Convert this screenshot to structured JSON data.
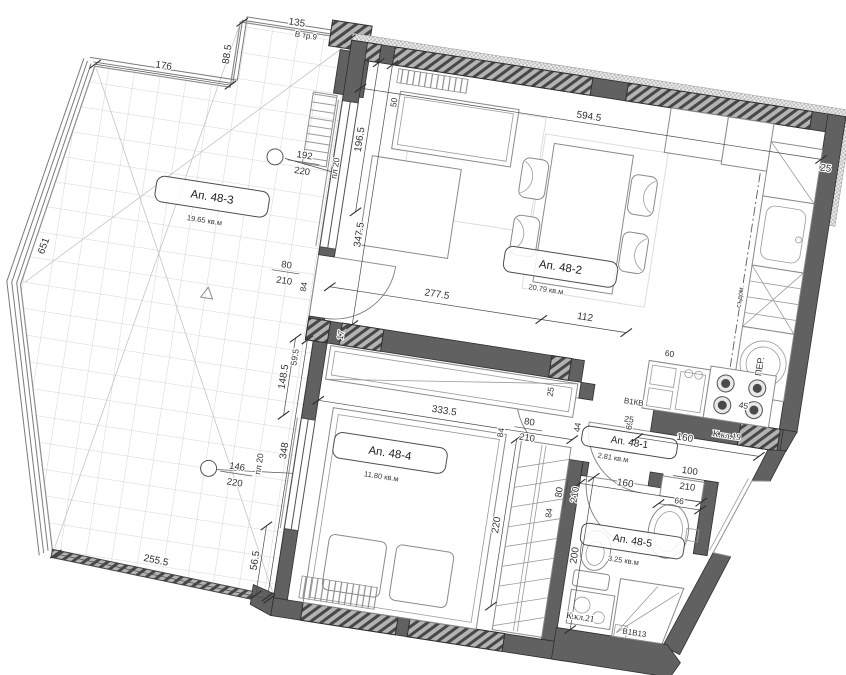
{
  "rooms": {
    "r48_2": {
      "name": "Ап. 48-2",
      "area": "20.79 кв.м"
    },
    "r48_3": {
      "name": "Ап. 48-3",
      "area": "19.65 кв.м"
    },
    "r48_4": {
      "name": "Ап. 48-4",
      "area": "11.80 кв.м"
    },
    "r48_1": {
      "name": "Ап. 48-1",
      "area": "2.81 кв.м"
    },
    "r48_5": {
      "name": "Ап. 48-5",
      "area": "3.25 кв.м"
    }
  },
  "dims": {
    "top_width": "594.5",
    "left_part": "196.5",
    "left_total": "347.5",
    "fifty": "50",
    "t_top_a": "176",
    "t_top_b": "135",
    "t_step": "88.5",
    "t_left": "651",
    "t_bottom": "255.5",
    "lv_a": "277.5",
    "lv_b": "112",
    "sixty": "60",
    "counter": "160",
    "sixty_nine": "69",
    "pier": "25",
    "step": "25",
    "corner": "25",
    "seg59": "59.5",
    "wall17": "17",
    "gap44": "44",
    "gap45": "45",
    "bw": "333.5",
    "bh": "348",
    "b_up": "148.5",
    "b_low": "56.5",
    "ward": "220",
    "bath_w": "160",
    "bath_n": "66",
    "bath_h": "200",
    "d84": "84"
  },
  "openings": {
    "win_living": {
      "w": "192",
      "h": "220"
    },
    "win_bedroom": {
      "w": "146",
      "h": "220"
    },
    "door": {
      "w": "80",
      "h": "210"
    },
    "entry": {
      "w": "100",
      "h": "210"
    }
  },
  "labels": {
    "vtr": "В тр.9",
    "pl20": "пл 20",
    "b1kv": "В1КВ",
    "kkl19": "К.кл.19",
    "kkl21": "К.кл.21",
    "b1v13": "В1В13",
    "washer": "ПЕР.",
    "dishwasher": "съдом."
  },
  "colors": {
    "wall": "#616161",
    "faint": "#c9c9c9",
    "text": "#3a3a3a",
    "paper": "#ffffff"
  }
}
